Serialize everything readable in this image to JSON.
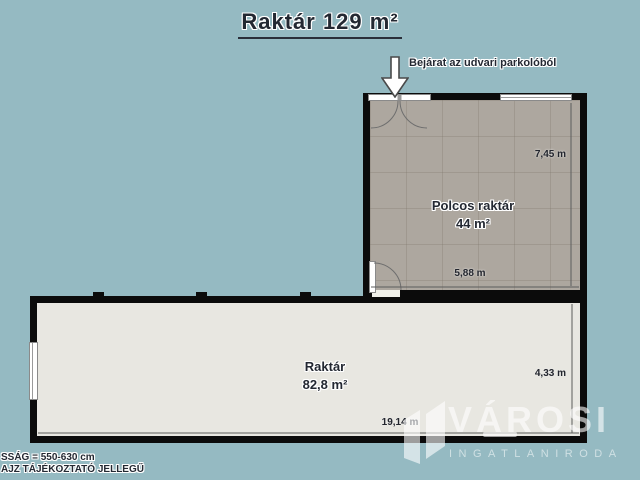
{
  "page": {
    "title": "Raktár 129 m²"
  },
  "entrance": {
    "label": "Bejárat az udvari parkolóból",
    "arrow_icon": "down-arrow"
  },
  "rooms": {
    "shelf_storage": {
      "name": "Polcos raktár",
      "area": "44 m²",
      "dim_vertical": "7,45 m",
      "dim_horizontal": "5,88 m"
    },
    "main_storage": {
      "name": "Raktár",
      "area": "82,8 m²",
      "dim_vertical": "4,33 m",
      "dim_horizontal": "19,14 m"
    }
  },
  "footnotes": {
    "line1": "SSÁG = 550-630 cm",
    "line2": "AJZ TÁJÉKOZTATÓ JELLEGŰ"
  },
  "watermark": {
    "brand": "VÁROSI",
    "subtitle": "INGATLANIRODA",
    "icon": "buildings-icon"
  },
  "colors": {
    "background": "#95bac2",
    "wall": "#0b0b0b",
    "tiled_floor": "#ada79f",
    "light_floor": "#e8e7e1",
    "text_dark": "#232832",
    "watermark": "#ffffff"
  }
}
